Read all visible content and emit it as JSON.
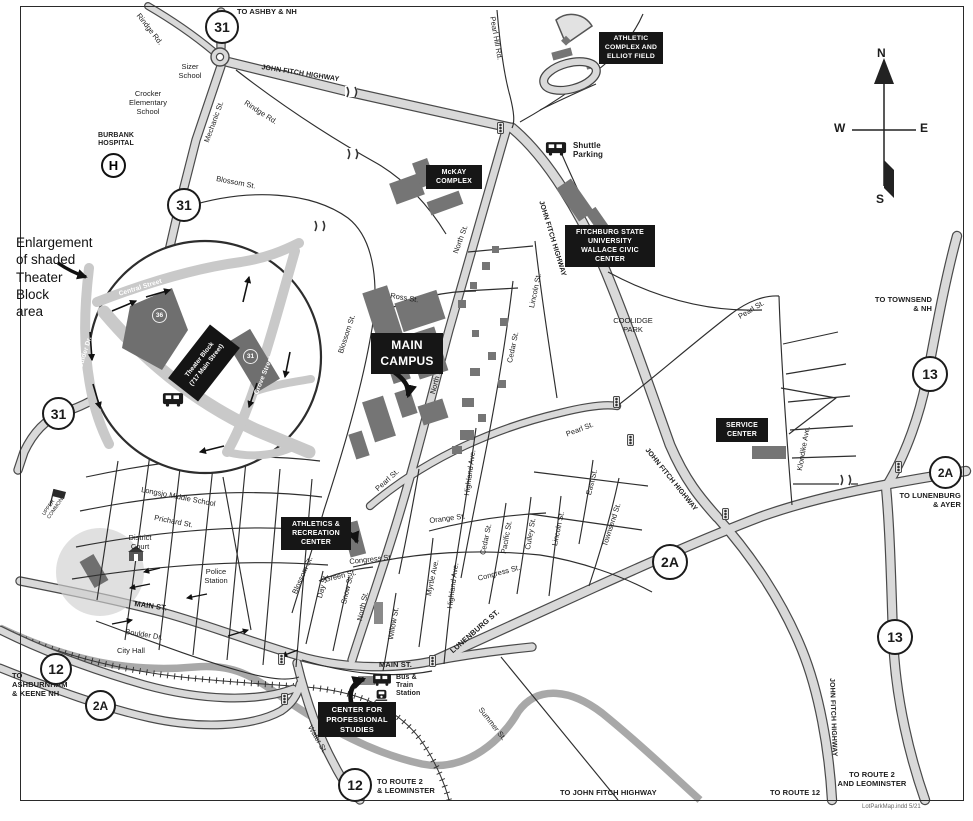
{
  "labels": {
    "to_ashby": "TO ASHBY & NH",
    "sizer": "Sizer\nSchool",
    "jfh": "JOHN FITCH HIGHWAY",
    "rindge": "Rindge Rd.",
    "mechanic": "Mechanic St.",
    "blossom": "Blossom St.",
    "crocker": "Crocker\nElementary\nSchool",
    "burbank": "BURBANK\nHOSPITAL",
    "hospital_h": "H",
    "pearl_hill": "Pearl Hill Rd.",
    "to_townsend": "TO TOWNSEND\n& NH",
    "coolidge": "COOLIDGE\nPARK",
    "ross": "Ross St.",
    "north": "North St.",
    "lincoln": "Lincoln St.",
    "cedar": "Cedar St.",
    "pearl": "Pearl St.",
    "klondike": "Klondike Ave.",
    "east": "East St.",
    "townsend_st": "Townsend St.",
    "orange": "Orange St.",
    "highland": "Highland Ave.",
    "myrtle": "Myrtle Ave.",
    "congress": "Congress St.",
    "pacific": "Pacific St.",
    "culley": "Culley St.",
    "green": "Green St.",
    "day": "Day St.",
    "snow": "Snow St.",
    "willow": "Willow St.",
    "lunenburg_st": "LUNENBURG ST.",
    "longsjo": "Longsjo Middle School",
    "prichard": "Prichard St.",
    "district_court": "District\nCourt",
    "police": "Police\nStation",
    "main_st": "MAIN ST.",
    "boulder": "Boulder Dr.",
    "city_hall": "City Hall",
    "to_ashburnham": "TO\nASHBURNHAM\n& KEENE NH",
    "water": "Water St.",
    "summer": "Summer St.",
    "to_route2_leom": "TO ROUTE 2\n& LEOMINSTER",
    "to_jfh": "TO JOHN FITCH HIGHWAY",
    "to_route12": "TO ROUTE 12",
    "to_route2_and_leom": "TO ROUTE 2\nAND LEOMINSTER",
    "to_lunenburg": "TO LUNENBURG\n& AYER",
    "upper_common": "UPPER\nCOMMON",
    "footer": "LotParkMap.indd   5/21"
  },
  "transit": {
    "shuttle": "Shuttle\nParking",
    "bus_train": "Bus &\nTrain\nStation"
  },
  "boxes": {
    "athletic": "ATHLETIC\nCOMPLEX AND\nELLIOT FIELD",
    "mckay": "McKAY\nCOMPLEX",
    "fsu": "FITCHBURG STATE\nUNIVERSITY\nWALLACE CIVIC\nCENTER",
    "main_campus": "MAIN\nCAMPUS",
    "service": "SERVICE\nCENTER",
    "athletics": "ATHLETICS &\nRECREATION\nCENTER",
    "cps": "CENTER FOR\nPROFESSIONAL\nSTUDIES"
  },
  "shields": {
    "r31": "31",
    "r12": "12",
    "r13": "13",
    "r2a": "2A"
  },
  "compass": {
    "n": "N",
    "w": "W",
    "e": "E",
    "s": "S"
  },
  "enlargement": {
    "note": "Enlargement\nof shaded\nTheater\nBlock\narea",
    "central": "Central Street",
    "boulder_dr": "Boulder Dr.",
    "main_street": "Main Street",
    "grove": "Grove Street",
    "theater": "Theater Block\n(717 Main Street)",
    "lot_a": "36",
    "lot_b": "31"
  },
  "colors": {
    "road_fill": "#d9d9d9",
    "road_casing": "#4a4a4a",
    "label_box": "#161616",
    "building": "#757575",
    "river": "#999999"
  }
}
